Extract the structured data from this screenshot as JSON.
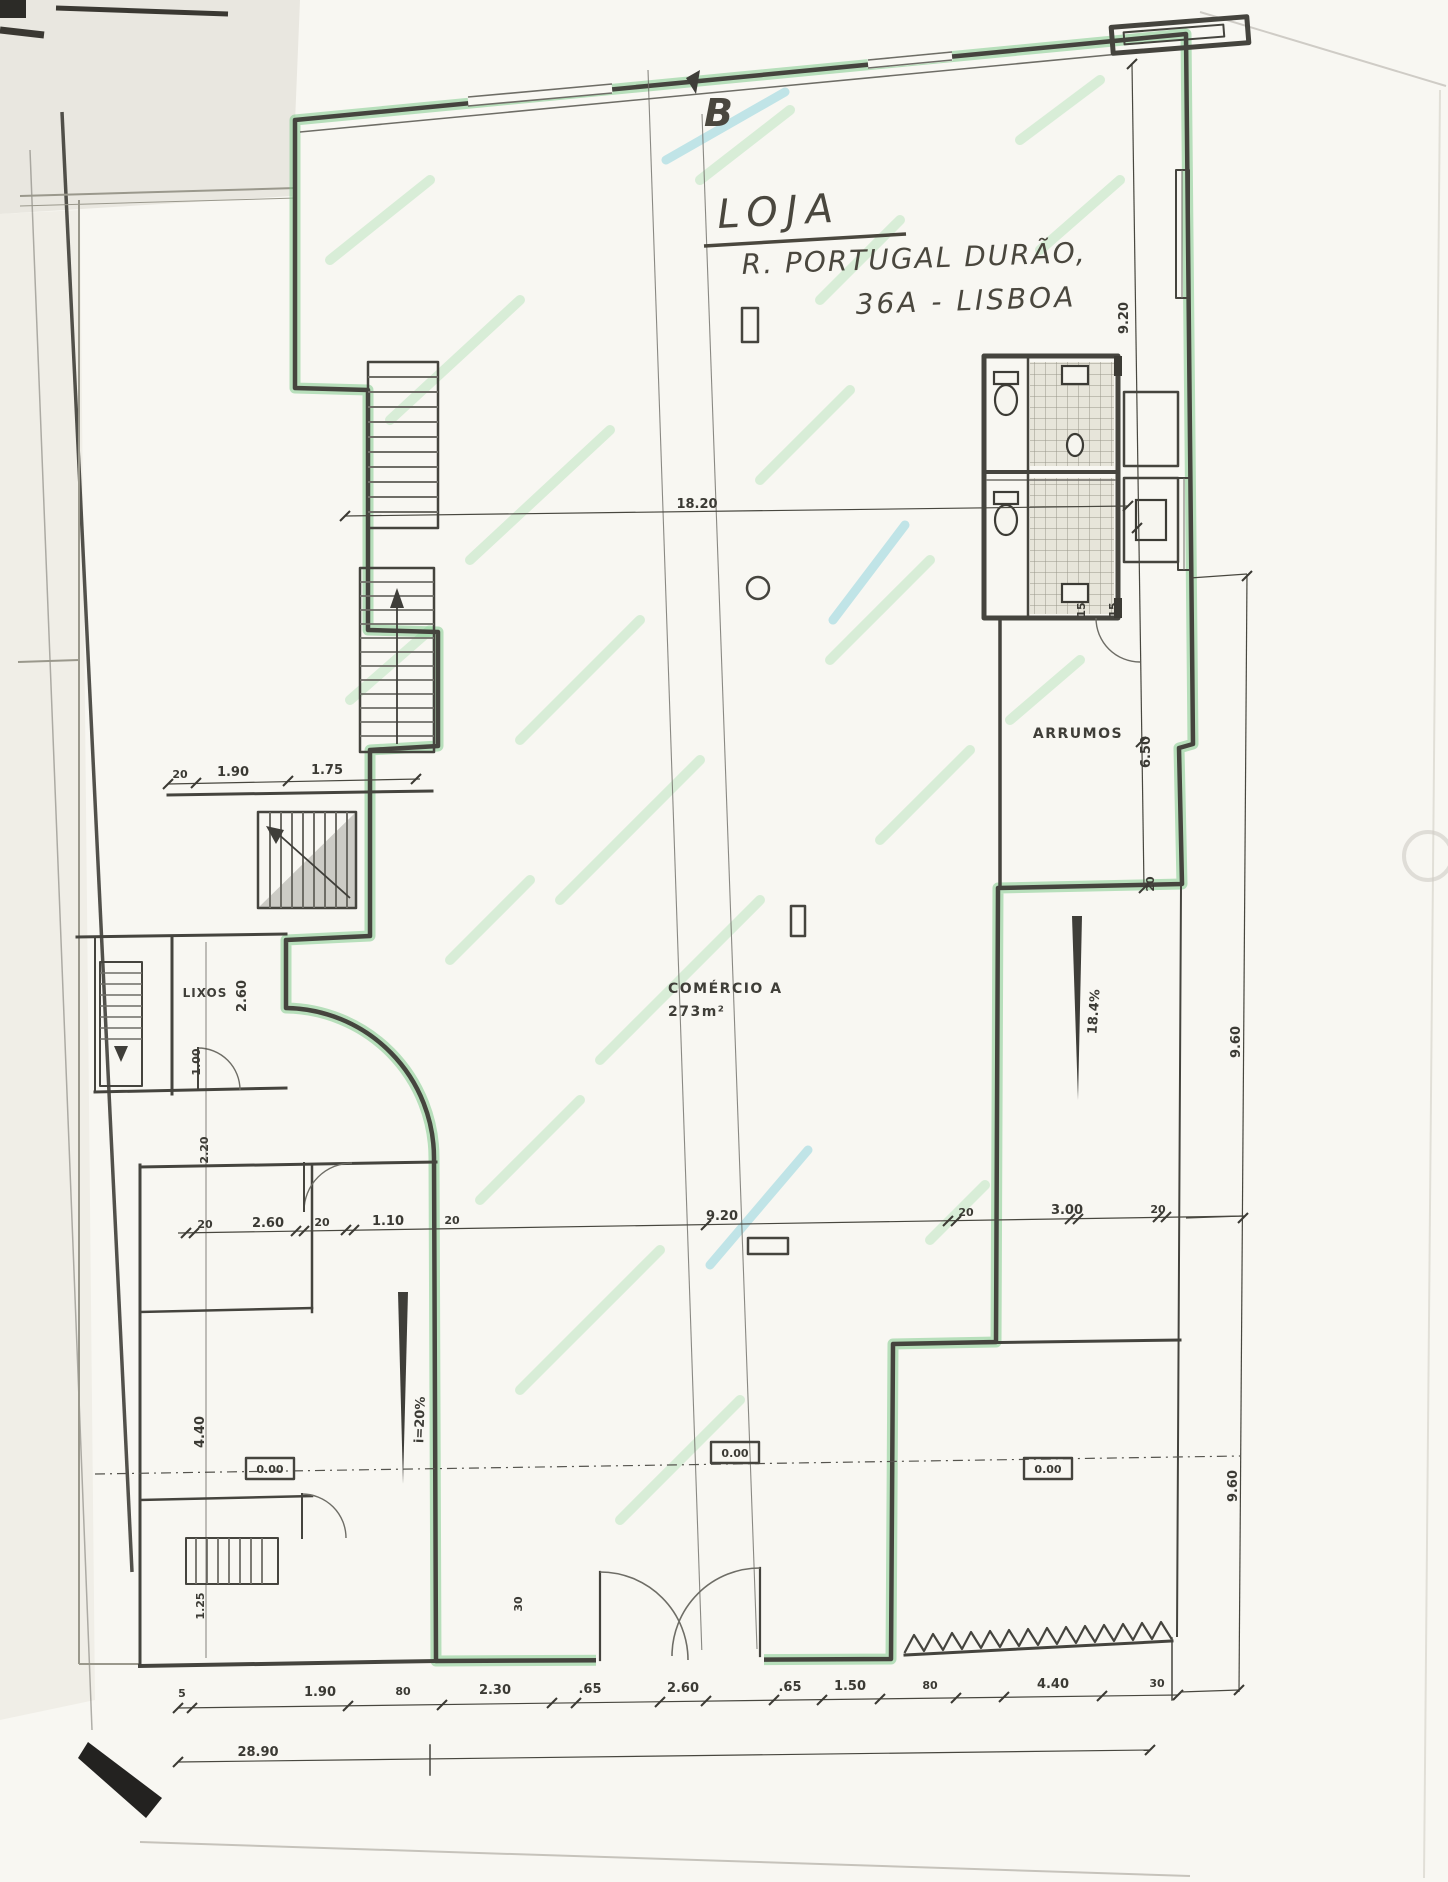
{
  "annotations": {
    "section_marker": "B",
    "title": "LOJA",
    "address_line1": "R. PORTUGAL DURÃO,",
    "address_line2": "36A - LISBOA"
  },
  "rooms": {
    "storage": "ARRUMOS",
    "trash": "LIXOS",
    "commerce_name": "COMÉRCIO A",
    "commerce_area": "273m²"
  },
  "levels": {
    "left": "0.00",
    "center": "0.00",
    "right": "0.00"
  },
  "slopes": {
    "left_ramp": "i=20%",
    "right_ramp": "18.4%"
  },
  "dimensions": {
    "top_width": "18.20",
    "overall_width": "28.90",
    "upper_left_row": [
      "20",
      "1.90",
      "1.75"
    ],
    "mid_row_left": [
      "20",
      "2.60",
      "20",
      "1.10",
      "20"
    ],
    "mid_row_center": "9.20",
    "mid_row_right": [
      "20",
      "3.00",
      "20"
    ],
    "bottom_row": [
      "5",
      "1.90",
      "80",
      "2.30",
      ".65",
      "2.60",
      ".65",
      "1.50",
      "80",
      "4.40",
      "30"
    ],
    "right_column": [
      "9.20",
      "6.50",
      "20"
    ],
    "far_right_column": [
      "9.60",
      "9.60"
    ],
    "left_column": [
      "2.60",
      "1.00",
      "2.20",
      "4.40",
      "1.25"
    ],
    "wc_dims": [
      "15",
      "15"
    ],
    "entrance_dim": "30"
  }
}
